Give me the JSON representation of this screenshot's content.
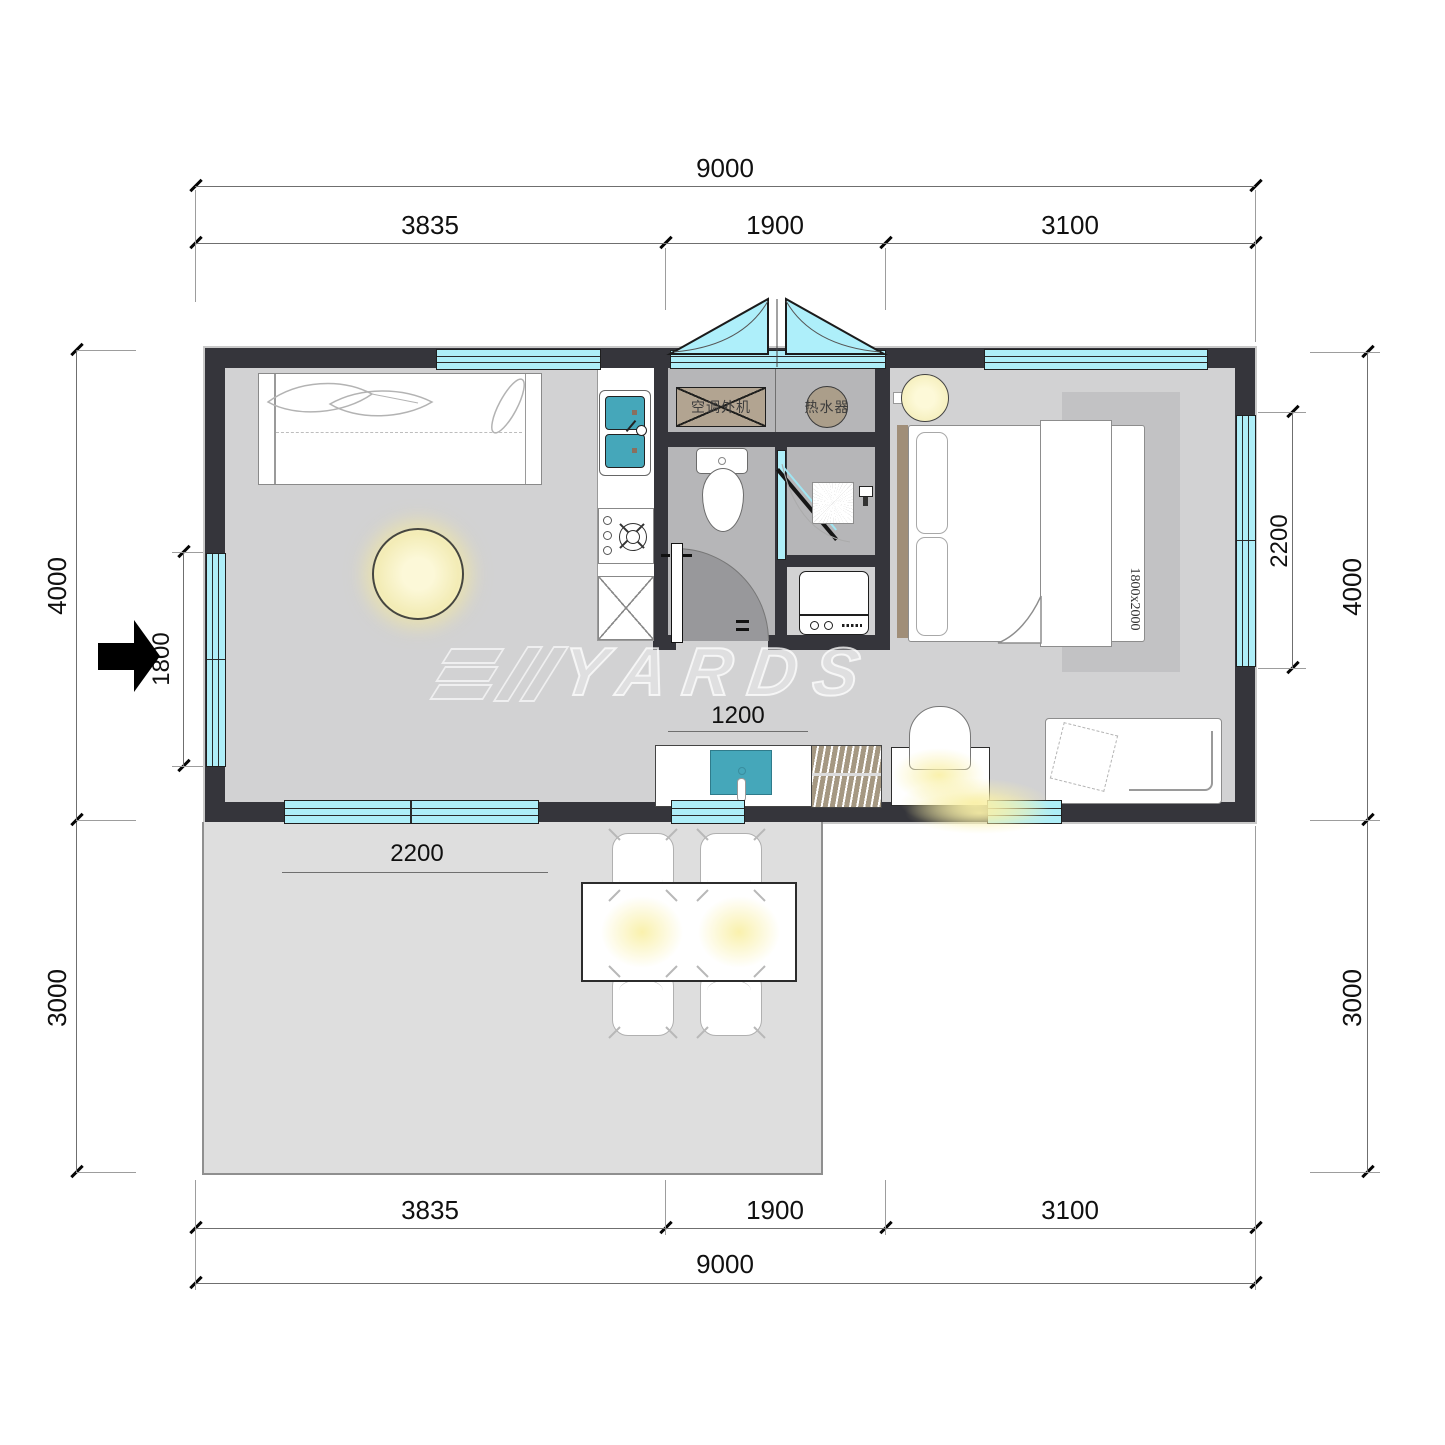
{
  "drawing": {
    "type": "floor-plan",
    "watermark": {
      "text": "YARDS"
    }
  },
  "dims": {
    "top": {
      "total": "9000",
      "segments": [
        "3835",
        "1900",
        "3100"
      ]
    },
    "bottom": {
      "total": "9000",
      "segments": [
        "3835",
        "1900",
        "3100"
      ]
    },
    "left": {
      "upper": "4000",
      "lower": "3000",
      "window": "1800"
    },
    "right": {
      "upper": "4000",
      "lower": "3000",
      "window": "2200"
    },
    "interior": {
      "vanity": "1200",
      "patio_door": "2200"
    }
  },
  "equipment": {
    "ac_outdoor_unit": "空调外机",
    "water_heater": "热水器",
    "bed_size": "1800x2000"
  },
  "colors": {
    "wall": "#35353b",
    "window": "#aeeef8",
    "floor_main": "#d2d2d3",
    "floor_wet": "#b6b6b8",
    "patio": "#dedede",
    "rug": "#c2c2c4",
    "sink_teal": "#45a7ba",
    "equipment_tan": "#b2a491",
    "light_glow": "#f7f1bf"
  }
}
